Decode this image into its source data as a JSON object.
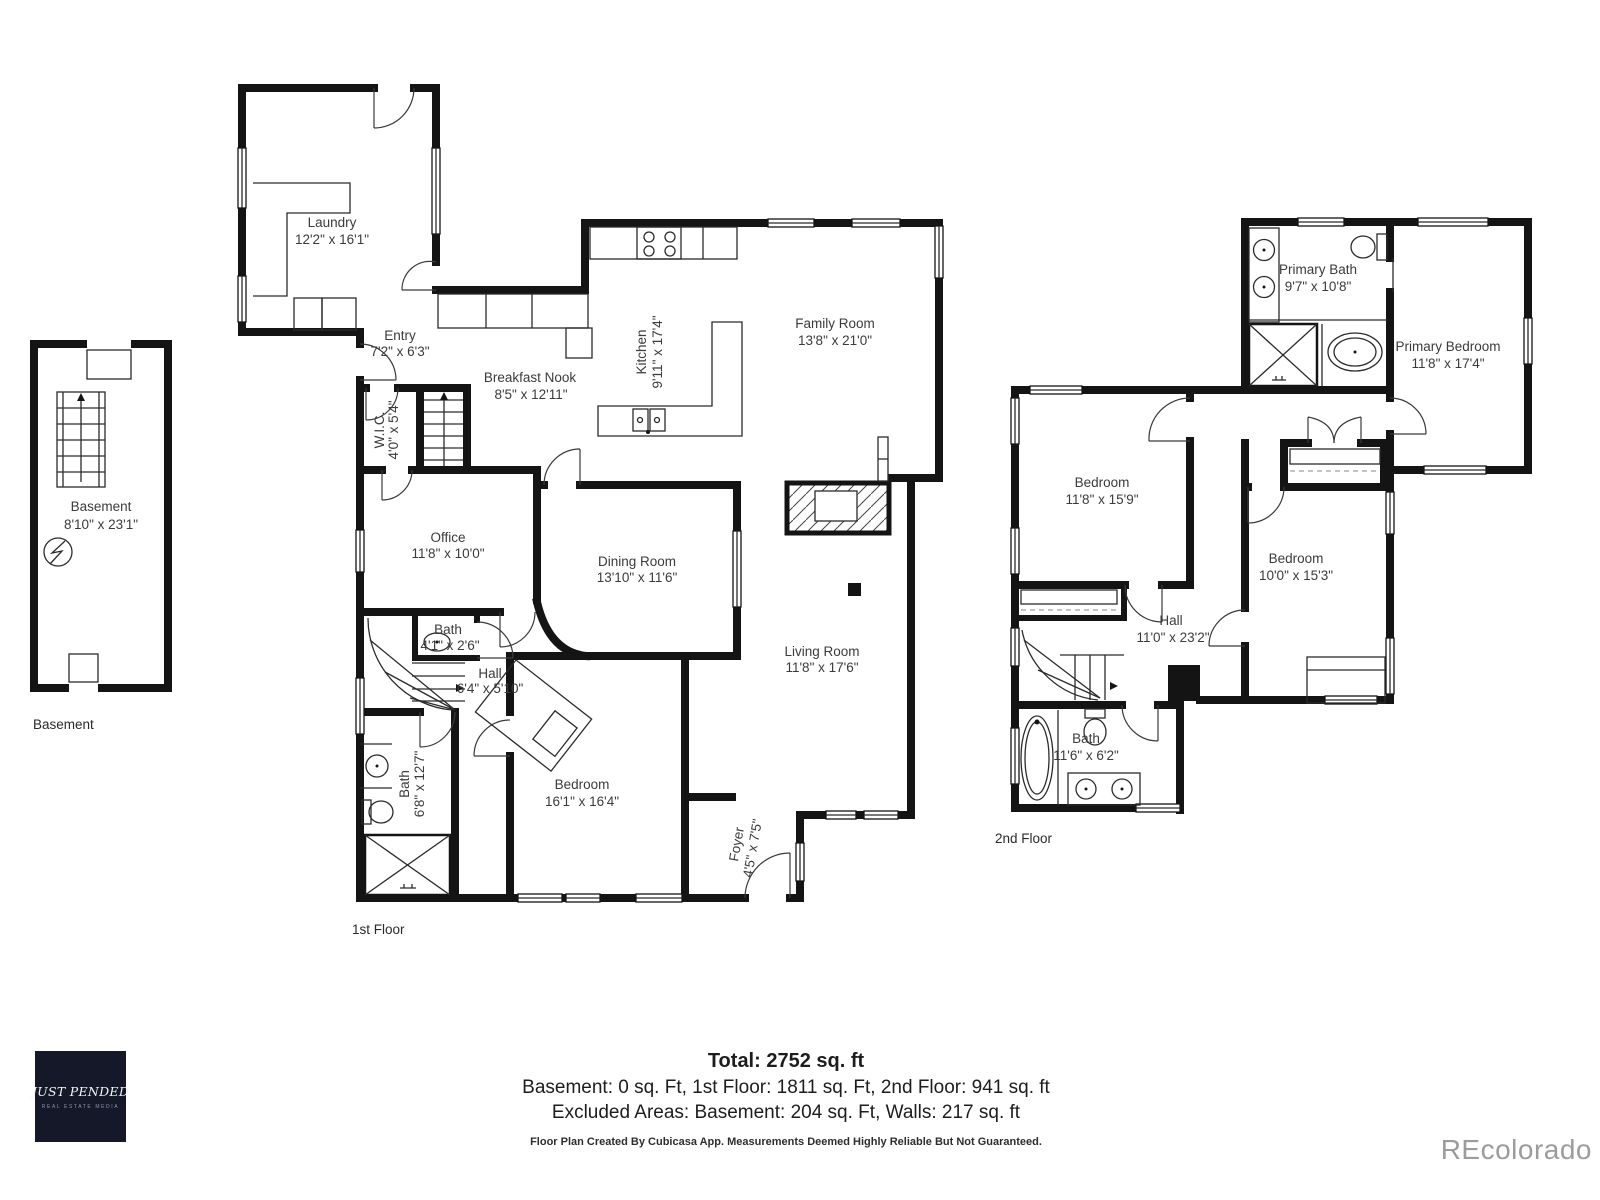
{
  "floors": {
    "basement": {
      "caption": "Basement",
      "room": {
        "name": "Basement",
        "dims": "8'10\" x 23'1\""
      }
    },
    "first": {
      "caption": "1st Floor",
      "rooms": {
        "laundry": {
          "name": "Laundry",
          "dims": "12'2\" x 16'1\""
        },
        "entry": {
          "name": "Entry",
          "dims": "7'2\" x 6'3\""
        },
        "wic": {
          "name": "W.I.C.",
          "dims": "4'0\" x 5'4\""
        },
        "breakfast_nook": {
          "name": "Breakfast Nook",
          "dims": "8'5\" x 12'11\""
        },
        "kitchen": {
          "name": "Kitchen",
          "dims": "9'11\" x 17'4\""
        },
        "family_room": {
          "name": "Family Room",
          "dims": "13'8\" x 21'0\""
        },
        "office": {
          "name": "Office",
          "dims": "11'8\" x 10'0\""
        },
        "dining_room": {
          "name": "Dining Room",
          "dims": "13'10\" x 11'6\""
        },
        "living_room": {
          "name": "Living Room",
          "dims": "11'8\" x 17'6\""
        },
        "bath_powder": {
          "name": "Bath",
          "dims": "4'1\" x 2'6\""
        },
        "hall": {
          "name": "Hall",
          "dims": "6'4\" x 5'10\""
        },
        "bath_main": {
          "name": "Bath",
          "dims": "6'8\" x 12'7\""
        },
        "bedroom": {
          "name": "Bedroom",
          "dims": "16'1\" x 16'4\""
        },
        "foyer": {
          "name": "Foyer",
          "dims": "4'5\" x 7'5\""
        }
      }
    },
    "second": {
      "caption": "2nd Floor",
      "rooms": {
        "primary_bath": {
          "name": "Primary Bath",
          "dims": "9'7\" x 10'8\""
        },
        "primary_bedroom": {
          "name": "Primary Bedroom",
          "dims": "11'8\" x 17'4\""
        },
        "bedroom_a": {
          "name": "Bedroom",
          "dims": "11'8\" x 15'9\""
        },
        "bedroom_b": {
          "name": "Bedroom",
          "dims": "10'0\" x 15'3\""
        },
        "hall": {
          "name": "Hall",
          "dims": "11'0\" x 23'2\""
        },
        "bath": {
          "name": "Bath",
          "dims": "11'6\" x 6'2\""
        }
      }
    }
  },
  "summary": {
    "total": "Total: 2752 sq. ft",
    "areas": "Basement: 0 sq. Ft, 1st Floor: 1811 sq. Ft, 2nd Floor: 941 sq. ft",
    "excluded": "Excluded Areas: Basement: 204 sq. Ft, Walls: 217 sq. ft",
    "disclaimer": "Floor Plan Created By Cubicasa App. Measurements Deemed Highly Reliable But Not Guaranteed."
  },
  "branding": {
    "logo_title": "JUST PENDED",
    "logo_subtitle": "REAL ESTATE MEDIA",
    "watermark": "REcolorado"
  },
  "colors": {
    "wall": "#141414",
    "label_text": "#3b3b3b",
    "logo_bg": "#141828",
    "watermark": "#9c9c9c"
  }
}
